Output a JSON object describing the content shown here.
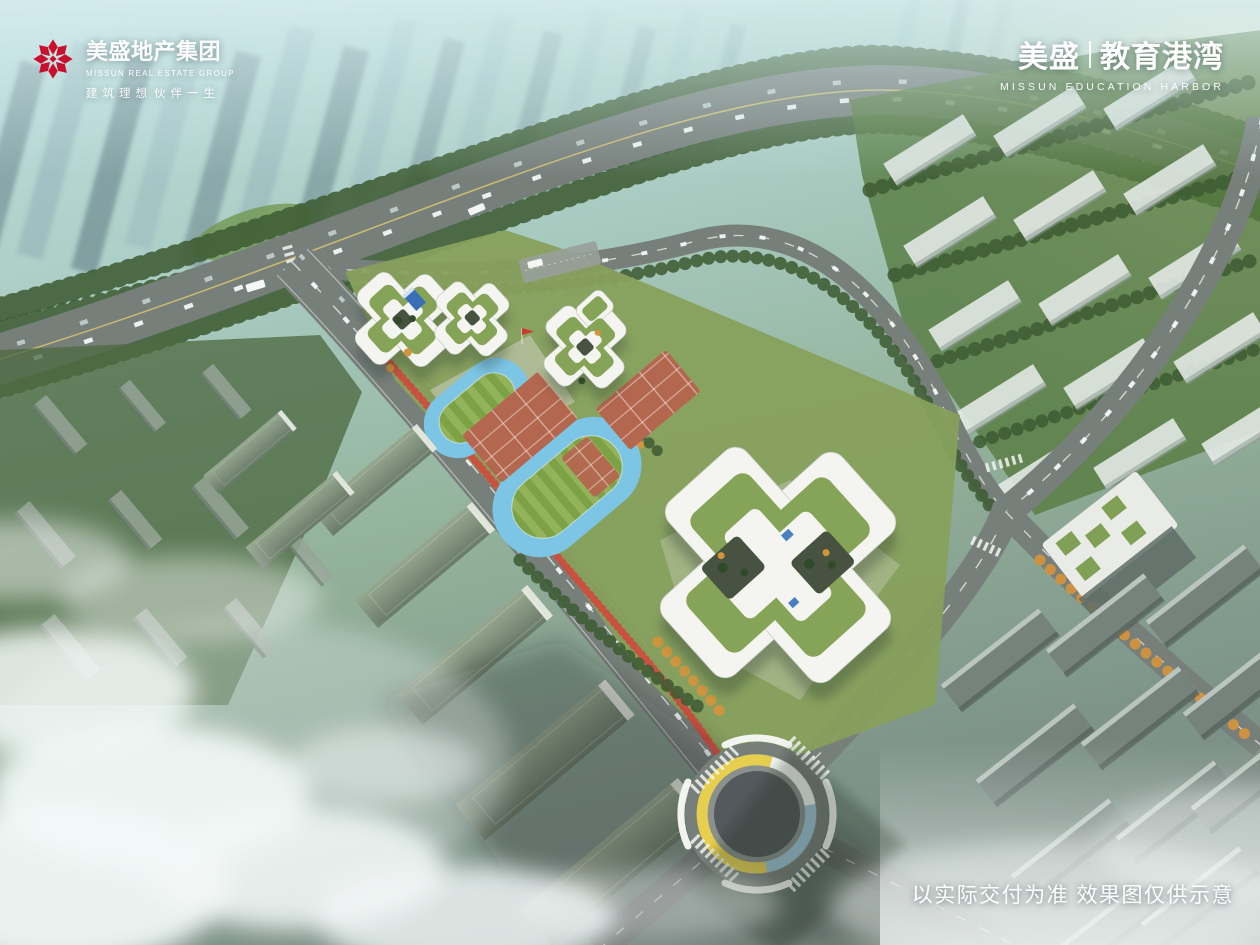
{
  "header": {
    "developer": {
      "emblem_icon": "flower-knot-emblem",
      "name_cn": "美盛地产集团",
      "name_en": "MISSUN REAL ESTATE GROUP",
      "slogan_a": "建筑理想",
      "slogan_b": "伙伴一生"
    },
    "project": {
      "brand_cn": "美盛",
      "project_cn": "教育港湾",
      "name_en": "MISSUN EDUCATION HARBOR"
    }
  },
  "footer": {
    "disclaimer": "以实际交付为准 效果图仅供示意"
  },
  "scene": {
    "palette": {
      "logo_red": "#C8102E",
      "sky_haze": "#C3E2E4",
      "tree_green": "#3F5C33",
      "grass_green": "#87A05C",
      "road_gray": "#777F7B",
      "building_white": "#F4F5F0",
      "roof_garden_green": "#85A457",
      "track_blue": "#7CC5E5",
      "field_green": "#84A44E",
      "court_terracotta": "#B4674F",
      "accent_red_trees": "#CE4B3E",
      "autumn_orange": "#D4943C",
      "roundabout_yellow": "#E6CF4E",
      "roundabout_blue": "#9FC3D8",
      "cloud_white": "#F3F8F7",
      "sun_glow": "#FFF3D8"
    }
  }
}
